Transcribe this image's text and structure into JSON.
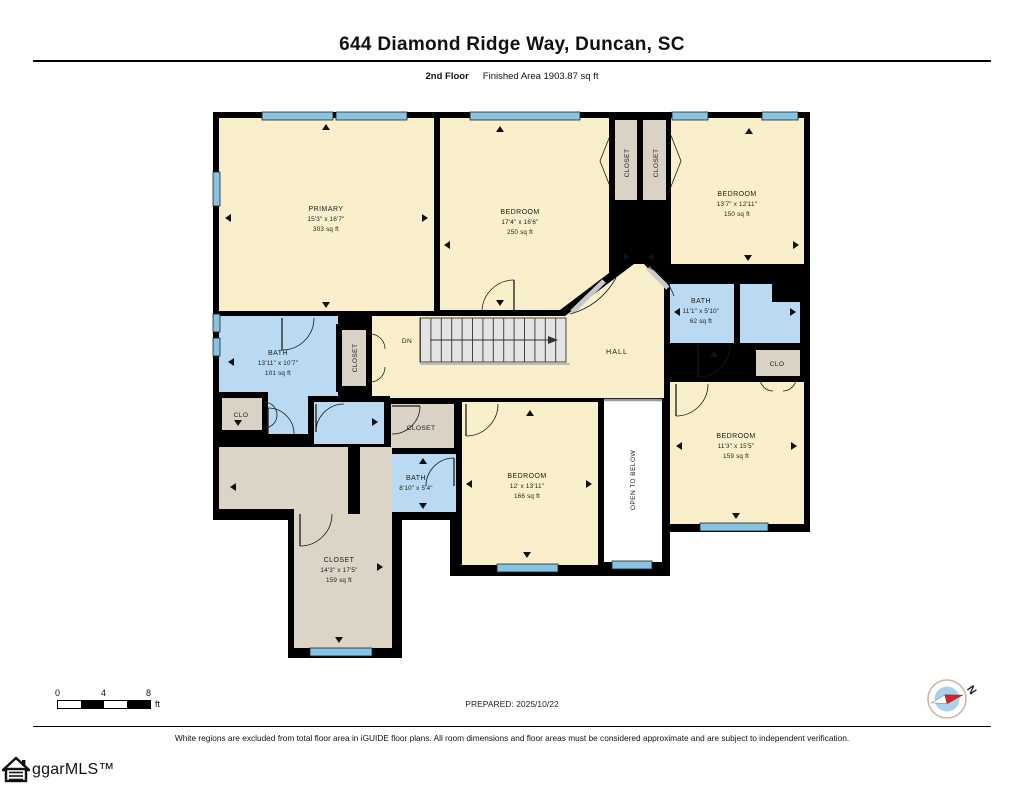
{
  "header": {
    "title": "644 Diamond Ridge Way, Duncan, SC",
    "floor_label": "2nd Floor",
    "area_label": "Finished Area 1903.87 sq ft"
  },
  "plan": {
    "rooms": {
      "primary": {
        "name": "PRIMARY",
        "dims": "15'3\" x 16'7\"",
        "area": "303 sq ft"
      },
      "bedroom_top": {
        "name": "BEDROOM",
        "dims": "17'4\" x 16'6\"",
        "area": "250 sq ft"
      },
      "closet_top_a": {
        "name": "CLOSET"
      },
      "closet_top_b": {
        "name": "CLOSET"
      },
      "bedroom_right_top": {
        "name": "BEDROOM",
        "dims": "13'7\" x 12'11\"",
        "area": "150 sq ft"
      },
      "bath_right": {
        "name": "BATH",
        "dims": "11'1\" x 5'10\"",
        "area": "62 sq ft"
      },
      "clo_right": {
        "name": "CLO"
      },
      "bedroom_right_bottom": {
        "name": "BEDROOM",
        "dims": "11'3\" x 15'5\"",
        "area": "159 sq ft"
      },
      "bath_left": {
        "name": "BATH",
        "dims": "13'11\" x 10'7\"",
        "area": "101 sq ft"
      },
      "clo_left": {
        "name": "CLO"
      },
      "closet_stairs": {
        "name": "CLOSET"
      },
      "stairs": {
        "name": "DN"
      },
      "hall": {
        "name": "HALL"
      },
      "closet_mid": {
        "name": "CLOSET"
      },
      "bath_mid": {
        "name": "BATH",
        "dims": "8'10\" x 5'4\""
      },
      "bedroom_mid": {
        "name": "BEDROOM",
        "dims": "12' x 13'11\"",
        "area": "166 sq ft"
      },
      "open_below": {
        "name": "OPEN TO BELOW"
      },
      "closet_big": {
        "name": "CLOSET",
        "dims": "14'3\" x 17'5\"",
        "area": "159 sq ft"
      }
    },
    "colors": {
      "room": "#FAEFCB",
      "bath": "#B9DAF2",
      "closet": "#D9D2C5",
      "wall": "#000000",
      "window": "#85C4E2",
      "stairs": "#E4E4E4",
      "open_to_below": "#FFFFFF"
    }
  },
  "footer": {
    "scale": {
      "zero": "0",
      "four": "4",
      "eight": "8",
      "unit": "ft"
    },
    "prepared": "PREPARED: 2025/10/22",
    "compass_label": "N",
    "disclaimer": "White regions are excluded from total floor area in iGUIDE floor plans. All room dimensions and floor areas must be considered approximate and are subject to independent verification.",
    "logo_text": "ggarMLS™"
  }
}
